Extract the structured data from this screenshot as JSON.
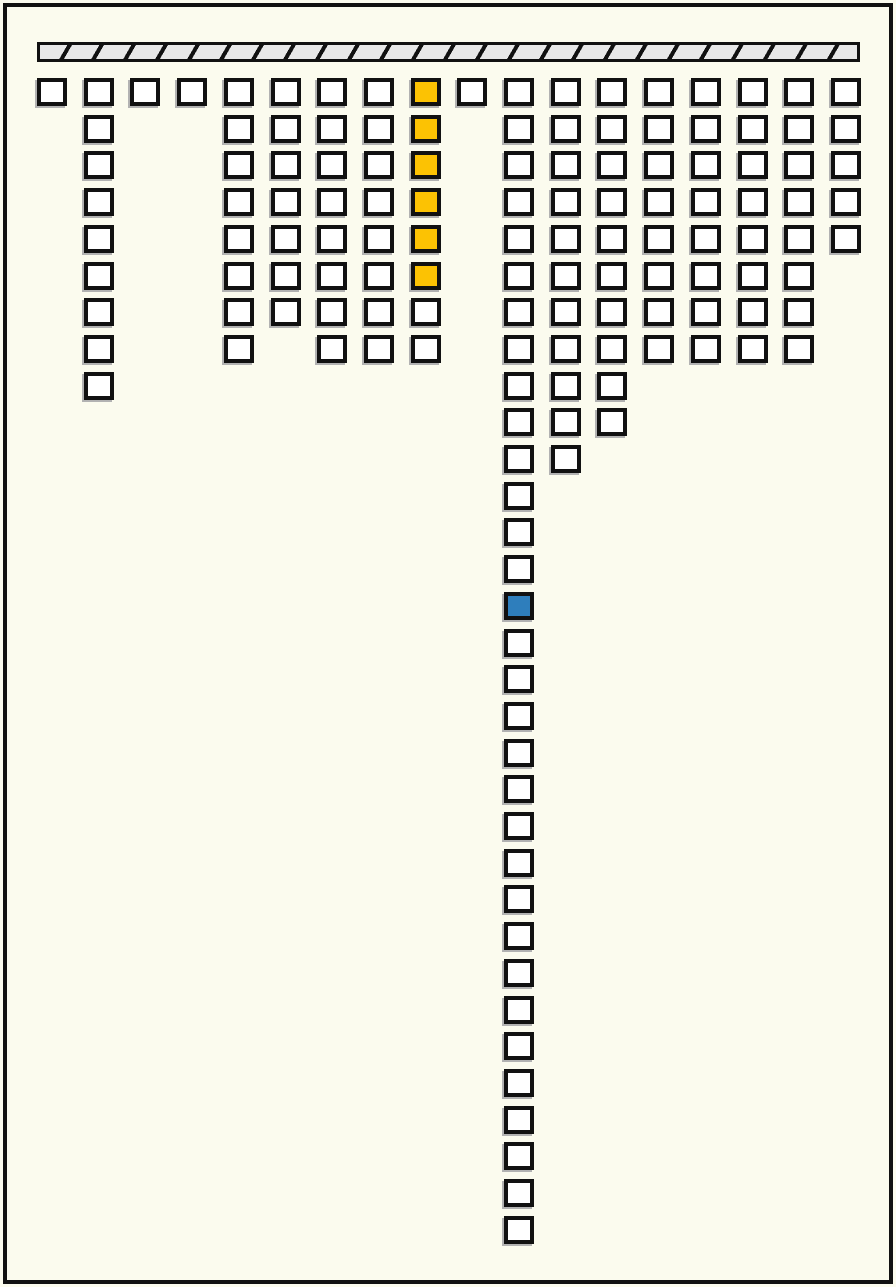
{
  "title": "",
  "palette": {
    "background": "#fbfbee",
    "ink": "#111111",
    "cell_fill": "#ffffff",
    "highlight_yellow": "#fcc203",
    "highlight_blue": "#2e7ebc",
    "cell_shadow": "#b2b2b2",
    "bar_fill": "#e8e8e8"
  },
  "ceiling_bar": {
    "x": 37,
    "y": 42,
    "width": 823,
    "height": 20,
    "hatch_period_px": 27.7,
    "hatch_line_px": 4
  },
  "grid": {
    "col_start": 37,
    "col_step": 46.7,
    "row_start": 78,
    "row_step": 36.7,
    "columns": [
      {
        "id": 1,
        "cells": 1
      },
      {
        "id": 2,
        "cells": 9
      },
      {
        "id": 3,
        "cells": 1
      },
      {
        "id": 4,
        "cells": 1
      },
      {
        "id": 5,
        "cells": 8
      },
      {
        "id": 6,
        "cells": 7
      },
      {
        "id": 7,
        "cells": 8
      },
      {
        "id": 8,
        "cells": 8
      },
      {
        "id": 9,
        "cells": 8,
        "highlight_rows": [
          1,
          2,
          3,
          4,
          5,
          6
        ],
        "highlight_color": "#fcc203"
      },
      {
        "id": 10,
        "cells": 1
      },
      {
        "id": 11,
        "cells": 32,
        "highlight_rows": [
          15
        ],
        "highlight_color": "#2e7ebc"
      },
      {
        "id": 12,
        "cells": 11
      },
      {
        "id": 13,
        "cells": 10
      },
      {
        "id": 14,
        "cells": 8
      },
      {
        "id": 15,
        "cells": 8
      },
      {
        "id": 16,
        "cells": 8
      },
      {
        "id": 17,
        "cells": 8
      },
      {
        "id": 18,
        "cells": 5
      }
    ]
  }
}
